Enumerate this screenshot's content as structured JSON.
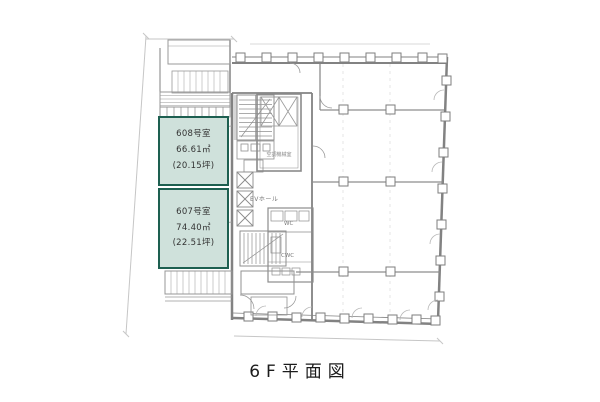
{
  "caption": "6F平面図",
  "rooms": [
    {
      "name": "608号室",
      "area_sqm": "66.61㎡",
      "area_tsubo": "(20.15坪)"
    },
    {
      "name": "607号室",
      "area_sqm": "74.40㎡",
      "area_tsubo": "(22.51坪)"
    }
  ],
  "core_labels": {
    "ev_hall": "EVホール",
    "machine_room": "空調機械室",
    "wc": "WC",
    "cwc": "CWC"
  },
  "colors": {
    "highlight_fill": "#cfe1db",
    "highlight_border": "#1d5f50",
    "line": "#8a8a8a",
    "text": "#333333"
  }
}
